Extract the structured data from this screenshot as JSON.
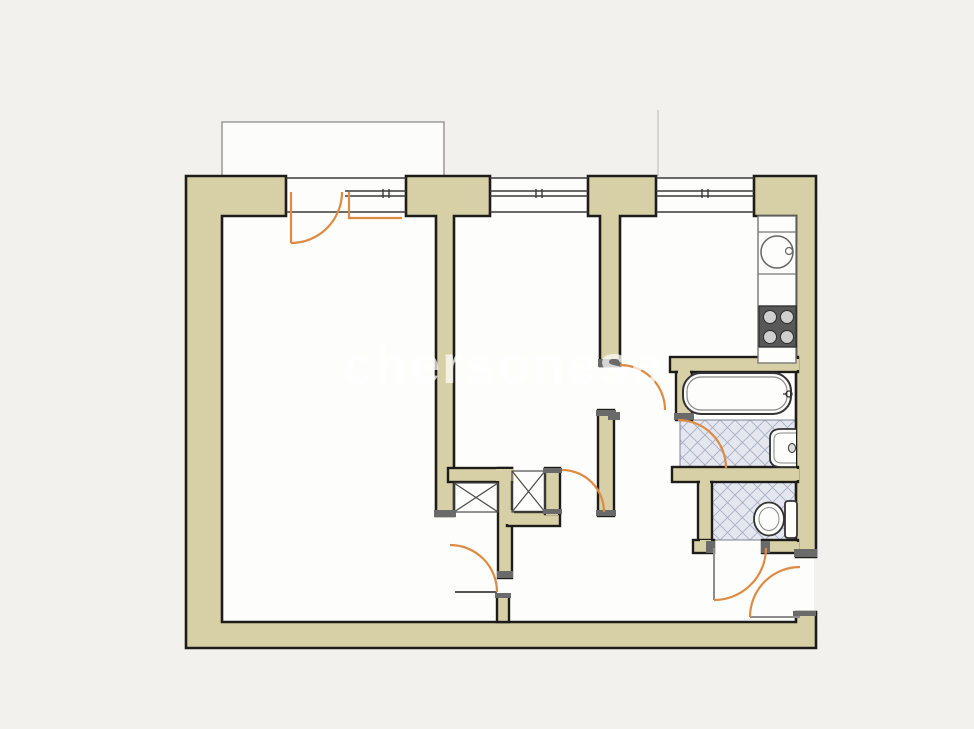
{
  "meta": {
    "background": "#f2f1ee",
    "floor": "#fdfdfc",
    "wall_fill": "#d7d0a6",
    "wall_stroke": "#1d1c18",
    "door_accent": "#dd8a45",
    "leaf_gray": "#8c8c8c",
    "tile_fill": "#e4e7f0",
    "tile_line": "#a9afc2",
    "partition": "#555555",
    "cap": "#6a6a6a",
    "balcony_line": "#9a9a9a",
    "window_line": "#3a3a3a",
    "fixture_line": "#333333",
    "fixture_soft": "#888888",
    "stove_fill": "#585858",
    "burner_fill": "#cfcfcf",
    "watermark_color": "#ffffff"
  },
  "watermark": {
    "text": "chersonese",
    "x": 343,
    "y": 383,
    "size": 54,
    "opacity": 0.72,
    "letter_spacing": 2
  },
  "floor_rect": [
    190,
    178,
    624,
    468
  ],
  "balcony": {
    "fill_rect": [
      222,
      122,
      222,
      56
    ],
    "outline": "M222,178 V122 H444 V178",
    "divider_line": [
      658,
      110,
      658,
      176
    ]
  },
  "walls": {
    "pieces": [
      {
        "name": "outer-wall-left-bottom",
        "d": "M186,176 H286 V216 H222 V622 H796 V612 H816 V648 H186 Z"
      },
      {
        "name": "pier-room-divider",
        "d": "M406,176 H490 V216 H454 V516 H436 V216 H406 Z"
      },
      {
        "name": "pier-hall-divider",
        "d": "M588,176 H656 V216 H620 V366 H600 V216 H588 Z"
      },
      {
        "name": "outer-wall-right",
        "d": "M754,176 H816 V557 H796 V216 H754 Z"
      }
    ],
    "rects": [
      {
        "name": "hall-wall",
        "x": 598,
        "y": 410,
        "w": 16,
        "h": 106
      },
      {
        "name": "closet-top-wall",
        "x": 448,
        "y": 468,
        "w": 64,
        "h": 14
      },
      {
        "name": "closet-mid-wall",
        "x": 498,
        "y": 468,
        "w": 14,
        "h": 110
      },
      {
        "name": "closet-bottom-wall",
        "x": 507,
        "y": 512,
        "w": 53,
        "h": 14
      },
      {
        "name": "closet-right-wall",
        "x": 545,
        "y": 468,
        "w": 15,
        "h": 46
      },
      {
        "name": "hall-stem-wall",
        "x": 497,
        "y": 595,
        "w": 12,
        "h": 27
      },
      {
        "name": "bathroom-top-wall",
        "x": 670,
        "y": 357,
        "w": 128,
        "h": 15
      },
      {
        "name": "bathroom-left-wall",
        "x": 676,
        "y": 372,
        "w": 16,
        "h": 48
      },
      {
        "name": "bathroom-wc-divider",
        "x": 672,
        "y": 467,
        "w": 126,
        "h": 15
      },
      {
        "name": "wc-left-wall",
        "x": 698,
        "y": 482,
        "w": 14,
        "h": 63
      },
      {
        "name": "wc-bottom-wall-left",
        "x": 693,
        "y": 540,
        "w": 21,
        "h": 13
      },
      {
        "name": "wc-bottom-wall-right",
        "x": 762,
        "y": 540,
        "w": 36,
        "h": 13
      }
    ],
    "patches": [
      [
        496,
        469,
        18,
        12
      ],
      [
        500,
        510,
        14,
        14
      ],
      [
        546,
        510,
        12,
        5
      ],
      [
        793,
        359,
        6,
        11
      ],
      [
        793,
        469,
        6,
        11
      ],
      [
        700,
        479,
        10,
        6
      ],
      [
        700,
        540,
        11,
        6
      ],
      [
        793,
        542,
        6,
        9
      ],
      [
        678,
        370,
        12,
        5
      ]
    ],
    "caps": [
      [
        434,
        510,
        22,
        7
      ],
      [
        598,
        359,
        23,
        8
      ],
      [
        596,
        410,
        20,
        6
      ],
      [
        596,
        510,
        20,
        6
      ],
      [
        543,
        468,
        19,
        5
      ],
      [
        543,
        509,
        19,
        5
      ],
      [
        497,
        571,
        16,
        7
      ],
      [
        495,
        593,
        16,
        5
      ],
      [
        674,
        413,
        20,
        7
      ],
      [
        608,
        412,
        12,
        8
      ],
      [
        706,
        541,
        9,
        12
      ],
      [
        761,
        541,
        9,
        12
      ],
      [
        794,
        549,
        23,
        8
      ],
      [
        793,
        611,
        23,
        5
      ]
    ]
  },
  "windows": {
    "lines": [
      [
        286,
        178,
        406,
        178
      ],
      [
        286,
        212,
        406,
        212
      ],
      [
        345,
        191,
        406,
        191
      ],
      [
        345,
        196,
        406,
        196
      ],
      [
        490,
        178,
        588,
        178
      ],
      [
        490,
        191,
        588,
        191
      ],
      [
        490,
        196,
        588,
        196
      ],
      [
        490,
        212,
        588,
        212
      ],
      [
        656,
        178,
        754,
        178
      ],
      [
        656,
        191,
        754,
        191
      ],
      [
        656,
        196,
        754,
        196
      ],
      [
        656,
        212,
        754,
        212
      ]
    ],
    "ticks": [
      [
        383,
        189,
        383,
        198
      ],
      [
        389,
        189,
        389,
        198
      ],
      [
        536,
        189,
        536,
        198
      ],
      [
        542,
        189,
        542,
        198
      ],
      [
        702,
        189,
        702,
        198
      ],
      [
        708,
        189,
        708,
        198
      ]
    ]
  },
  "tiles": [
    {
      "name": "bathroom-floor-tiles",
      "x": 680,
      "y": 420,
      "w": 116,
      "h": 47
    },
    {
      "name": "wc-floor-tiles",
      "x": 712,
      "y": 482,
      "w": 84,
      "h": 58
    }
  ],
  "closets": {
    "boxes": [
      {
        "name": "closet-1",
        "x": 454,
        "y": 483,
        "w": 44,
        "h": 29
      },
      {
        "name": "closet-2",
        "x": 512,
        "y": 471,
        "w": 33,
        "h": 41
      }
    ]
  },
  "partitions": [
    {
      "name": "room1-door-threshold",
      "line": [
        455,
        592,
        497,
        592
      ]
    }
  ],
  "fixtures": {
    "kitchen_counter": {
      "rect": [
        758,
        216,
        38,
        147
      ],
      "dividers": [
        232,
        274,
        306,
        347
      ]
    },
    "kitchen_sink": {
      "cx": 777,
      "cy": 252,
      "r": 16,
      "tap": [
        789,
        251,
        3.5
      ]
    },
    "stove": {
      "rect": [
        759,
        306,
        37,
        41
      ],
      "burners": [
        [
          770,
          317
        ],
        [
          787,
          317
        ],
        [
          770,
          337
        ],
        [
          787,
          337
        ]
      ],
      "burner_r": 6.5
    },
    "bathtub": {
      "outer": [
        683,
        373,
        108,
        41,
        18
      ],
      "inner": [
        687,
        377,
        100,
        33,
        14
      ],
      "tap": [
        789,
        394
      ]
    },
    "washbasin": {
      "outer": "M796,429 H781 Q770,429 770,438 V458 Q770,467 781,467 H796",
      "inner": "M796,433 H782 Q774,433 774,440 V456 Q774,463 782,463 H796",
      "tap": [
        792,
        448
      ]
    },
    "toilet": {
      "tank": [
        785,
        501,
        12,
        37
      ],
      "bowl": [
        769,
        519,
        15,
        16.5
      ],
      "bowl_inner": [
        769,
        519,
        10,
        11.5
      ]
    }
  },
  "doors": {
    "arcs": [
      {
        "name": "balcony-door-arc",
        "d": "M291,243 A51,51 0 0 0 342,192"
      },
      {
        "name": "room2-door-arc",
        "d": "M620,365 A45,45 0 0 1 665,410"
      },
      {
        "name": "closet-door-arc",
        "d": "M562,470 A42,42 0 0 1 604,512"
      },
      {
        "name": "room1-door-arc",
        "d": "M450,545 A47,47 0 0 1 497,592"
      },
      {
        "name": "bathroom-door-arc",
        "d": "M678,420 A48,48 0 0 1 726,468"
      },
      {
        "name": "wc-door-arc",
        "d": "M766,548 A52,52 0 0 1 714,600"
      },
      {
        "name": "entrance-door-arc",
        "d": "M750,617 A50,50 0 0 1 800,567"
      }
    ],
    "orange_leaves": [
      {
        "name": "balcony-door-leaf",
        "line": [
          291,
          192,
          291,
          243
        ]
      },
      {
        "name": "window-vent-leaf",
        "path": "M349,192 V218 H402"
      }
    ],
    "gray_leaves": [
      {
        "name": "wc-door-leaf",
        "line": [
          714,
          548,
          714,
          600
        ]
      },
      {
        "name": "entrance-door-leaf",
        "line": [
          750,
          617,
          800,
          617
        ]
      }
    ]
  }
}
